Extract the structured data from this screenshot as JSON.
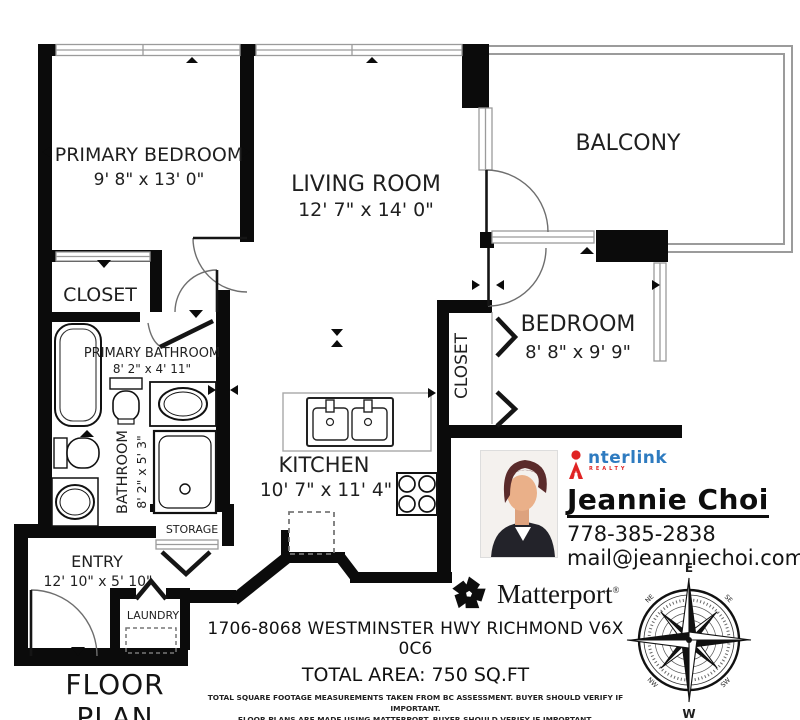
{
  "plan": {
    "title": "FLOOR PLAN",
    "rooms": {
      "primary_bedroom": {
        "label": "PRIMARY BEDROOM",
        "dims": "9' 8\" x 13' 0\""
      },
      "living_room": {
        "label": "LIVING ROOM",
        "dims": "12' 7\" x 14' 0\""
      },
      "balcony": {
        "label": "BALCONY"
      },
      "bedroom": {
        "label": "BEDROOM",
        "dims": "8' 8\" x 9' 9\""
      },
      "closet": {
        "label": "CLOSET"
      },
      "bedroom_closet": {
        "label": "CLOSET"
      },
      "primary_bathroom": {
        "label": "PRIMARY BATHROOM",
        "dims": "8' 2\" x 4' 11\""
      },
      "bathroom": {
        "label": "BATHROOM",
        "dims": "8' 2\" x 5' 3\""
      },
      "kitchen": {
        "label": "KITCHEN",
        "dims": "10' 7\" x 11' 4\""
      },
      "storage": {
        "label": "STORAGE"
      },
      "entry": {
        "label": "ENTRY",
        "dims": "12' 10\" x 5' 10\""
      },
      "laundry": {
        "label": "LAUNDRY"
      }
    }
  },
  "agent": {
    "brand": "nterlink",
    "brand_sub": "REALTY",
    "name": "Jeannie Choi",
    "phone": "778-385-2838",
    "email": "mail@jeanniechoi.com"
  },
  "branding": {
    "matterport": "Matterport",
    "registered": "®"
  },
  "footer": {
    "address": "1706-8068 WESTMINSTER HWY RICHMOND V6X 0C6",
    "total_area": "TOTAL AREA: 750 SQ.FT",
    "disclaimer_line1": "TOTAL SQUARE FOOTAGE MEASUREMENTS TAKEN FROM BC ASSESSMENT. BUYER SHOULD VERIFY IF IMPORTANT.",
    "disclaimer_line2": "FLOOR PLANS ARE MADE USING MATTERPORT. BUYER SHOULD VERIFY IF IMPORTANT."
  },
  "compass": {
    "n": "N",
    "e": "E",
    "s": "S",
    "w": "W",
    "ne": "NE",
    "se": "SE",
    "sw": "SW",
    "nw": "NW"
  },
  "colors": {
    "wall": "#0b0b0b",
    "balcony_outline": "#9b9b9b",
    "interlink_red": "#e02424",
    "interlink_blue": "#2e7bc0",
    "text": "#1a1a1a"
  }
}
